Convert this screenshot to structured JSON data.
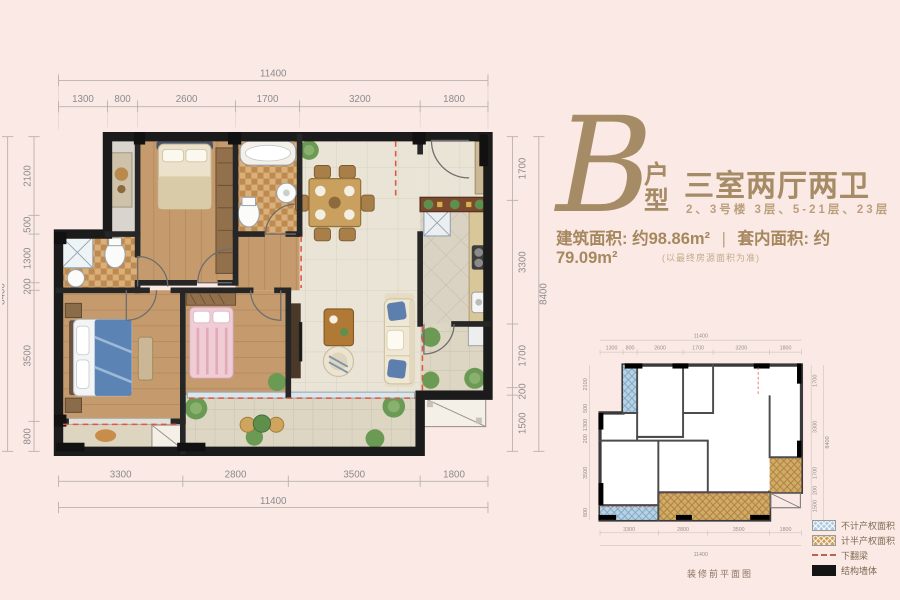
{
  "colors": {
    "background": "#fbe9e5",
    "accent": "#a6885f",
    "accent_light": "#bb9f7c",
    "dimension_text": "#8b8b8b",
    "wall": "#1b1b1b",
    "legend_blue": "#aecbdf",
    "legend_brown": "#cda35c",
    "beam_red": "#dd5742"
  },
  "header": {
    "plan_letter": "B",
    "plan_letter_suffix": "户型",
    "title": "三室两厅两卫",
    "subtitle": "2、3号楼  3层、5-21层、23层",
    "built_area_label": "建筑面积:",
    "built_area_value": "约98.86m²",
    "divider": "|",
    "inner_area_label": "套内面积:",
    "inner_area_value": "约79.09m²",
    "note": "(以最终房源面积为准)"
  },
  "main_plan": {
    "total_width": "11400",
    "total_height": "8400",
    "dims_top": [
      "1300",
      "800",
      "2600",
      "1700",
      "3200",
      "1800"
    ],
    "dims_bottom": [
      "3300",
      "2800",
      "3500",
      "1800"
    ],
    "dims_left": [
      "2100",
      "500",
      "1300",
      "200",
      "3500",
      "800"
    ],
    "dims_right": [
      "1700",
      "3300",
      "1700",
      "200",
      "1500"
    ]
  },
  "mini_plan": {
    "total_width": "11400",
    "total_height": "8400",
    "dims_top": [
      "1300",
      "800",
      "2600",
      "1700",
      "3200",
      "1800"
    ],
    "dims_bottom": [
      "3300",
      "2800",
      "3500",
      "1800"
    ],
    "dims_left": [
      "2100",
      "500",
      "1300",
      "200",
      "3500",
      "800"
    ],
    "dims_right": [
      "1700",
      "3300",
      "1700",
      "200",
      "1500"
    ],
    "caption": "装修前平面图"
  },
  "legend": {
    "items": [
      {
        "label": "不计产权面积",
        "swatch": "blue-hatch"
      },
      {
        "label": "计半产权面积",
        "swatch": "brown-hatch"
      },
      {
        "label": "下翻梁",
        "swatch": "dashed-line"
      },
      {
        "label": "结构墙体",
        "swatch": "solid-black"
      }
    ]
  }
}
